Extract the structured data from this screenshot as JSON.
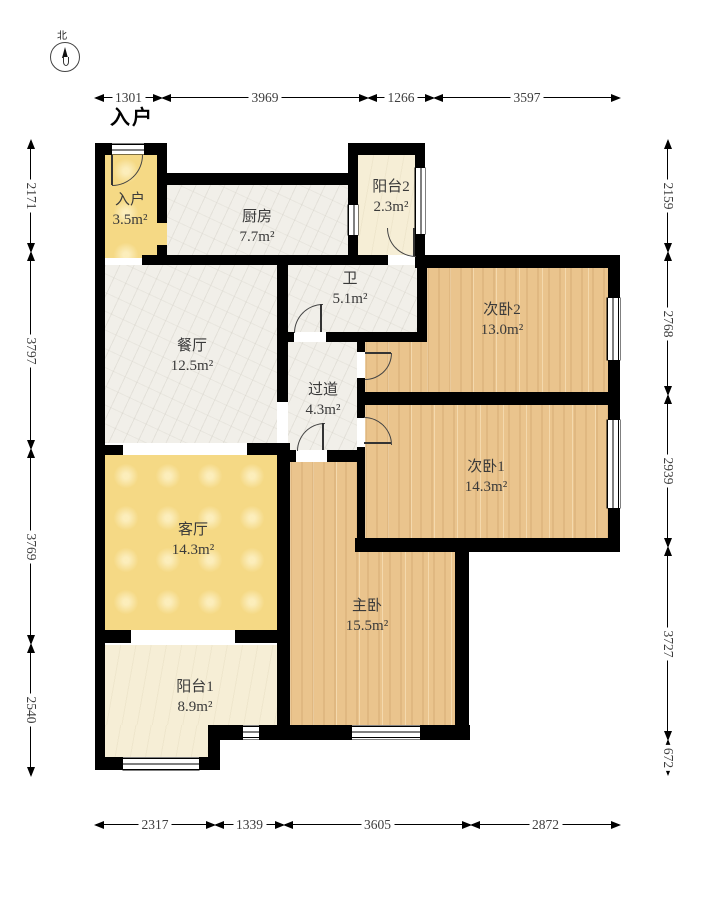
{
  "title": "户型图 (apartment floor plan)",
  "entrance_marker": "入户",
  "compass": {
    "north_label": "北"
  },
  "rooms": {
    "entry": {
      "label": "入户",
      "area": "3.5m²"
    },
    "kitchen": {
      "label": "厨房",
      "area": "7.7m²"
    },
    "balcony2": {
      "label": "阳台2",
      "area": "2.3m²"
    },
    "bathroom": {
      "label": "卫",
      "area": "5.1m²"
    },
    "dining": {
      "label": "餐厅",
      "area": "12.5m²"
    },
    "hallway": {
      "label": "过道",
      "area": "4.3m²"
    },
    "bedroom2": {
      "label": "次卧2",
      "area": "13.0m²"
    },
    "bedroom1": {
      "label": "次卧1",
      "area": "14.3m²"
    },
    "living": {
      "label": "客厅",
      "area": "14.3m²"
    },
    "master": {
      "label": "主卧",
      "area": "15.5m²"
    },
    "balcony1": {
      "label": "阳台1",
      "area": "8.9m²"
    }
  },
  "dimensions": {
    "top": [
      "1301",
      "3969",
      "1266",
      "3597"
    ],
    "bottom": [
      "2317",
      "1339",
      "3605",
      "2872"
    ],
    "left": [
      "2171",
      "3797",
      "3769",
      "2540"
    ],
    "right": [
      "2159",
      "2768",
      "2939",
      "3727",
      "672"
    ]
  },
  "colors": {
    "wall": "#000000",
    "wood_floor": "#eac48d",
    "gold_floor": "#f5d985",
    "marble_floor": "#f1efe9",
    "cream_floor": "#f6eed6",
    "dimension_text": "#3d3d3d"
  }
}
